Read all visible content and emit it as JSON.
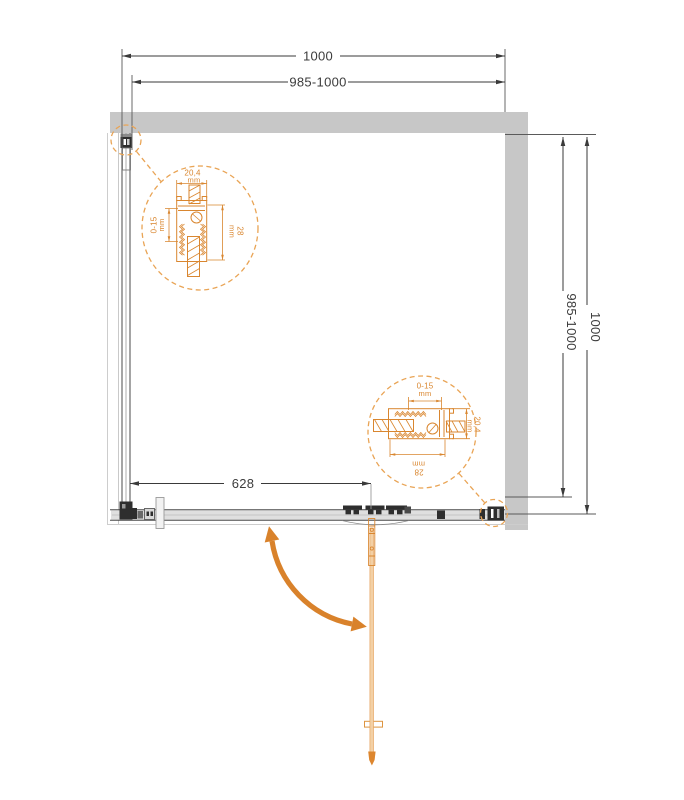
{
  "title": "Shower enclosure plan drawing",
  "dims": {
    "top_outer": "1000",
    "top_inner": "985-1000",
    "side_inner": "985-1000",
    "side_outer": "1000",
    "door_width": "628"
  },
  "detail_dims": {
    "profile_width": "20,4",
    "profile_width_unit": "mm",
    "adjustment": "0-15",
    "adjustment_unit": "mm",
    "profile_depth": "28",
    "profile_depth_unit": "mm"
  },
  "colors": {
    "wall": "#C7C7C7",
    "line": "#3A3A3A",
    "accent": "#D9862F",
    "dash_circle": "#E9A455",
    "door_fill": "#F3D0A5",
    "swing_arrow": "#D9822B"
  },
  "icons": {
    "swing_arrow": "door-swing-arrow"
  }
}
